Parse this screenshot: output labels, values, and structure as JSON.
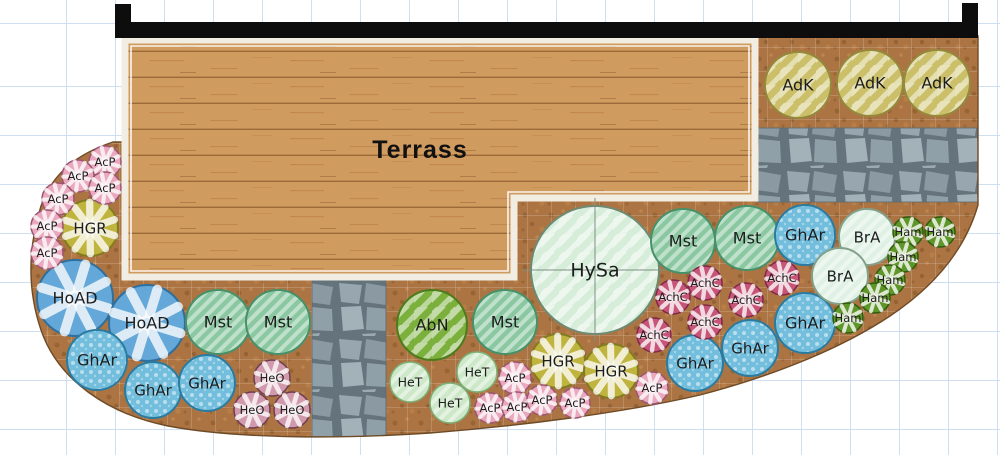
{
  "plan": {
    "terrace_label": "Terrass",
    "colors": {
      "soil": "#ab7442",
      "wood": "#d09b5f",
      "wood_line": "#9c6a38",
      "stone_gap": "#64737c",
      "stone": "#98a7af",
      "wall": "#0d0d0d",
      "grid_line": "#cddff0",
      "bed_outline": "#6e4b26",
      "label_text": "#1d1d1d"
    },
    "species": {
      "AcP": {
        "fill": "#e9a8be",
        "stroke": "#9c5570",
        "deco": "star",
        "spokes": 9
      },
      "HeO": {
        "fill": "#d09aac",
        "stroke": "#6f3c50",
        "deco": "star",
        "spokes": 8
      },
      "AchC": {
        "fill": "#c65578",
        "stroke": "#7f2847",
        "deco": "star",
        "spokes": 9
      },
      "Ham": {
        "fill": "#5f9629",
        "stroke": "#2f5c0e",
        "deco": "star",
        "spokes": 8
      },
      "HGR": {
        "fill": "#bfb43d",
        "stroke": "#837b20",
        "deco": "star",
        "spokes": 10
      },
      "HoAD": {
        "fill": "#63a8d8",
        "stroke": "#2e6f9d",
        "deco": "star",
        "spokes": 8
      },
      "AdK": {
        "fill": "#cbc069",
        "stroke": "#94893c",
        "deco": "hatch2"
      },
      "GhAr": {
        "fill": "#72bedc",
        "stroke": "#2b7ba0",
        "deco": "dots"
      },
      "Mst": {
        "fill": "#8bc8a2",
        "stroke": "#47906a",
        "deco": "hatch1"
      },
      "AbN": {
        "fill": "#7bb03d",
        "stroke": "#4e7b1b",
        "deco": "hatch2"
      },
      "HeT": {
        "fill": "#cde8c8",
        "stroke": "#7cb077",
        "deco": "hatch1"
      },
      "HySa": {
        "fill": "#d6edda",
        "stroke": "#6d8a74",
        "deco": "hatch2",
        "crosshair": true
      },
      "BrA": {
        "fill": "#def1e4",
        "stroke": "#84a08b",
        "deco": "hatch1"
      }
    },
    "plants": [
      {
        "code": "HySa",
        "x": 595,
        "y": 270,
        "r": 64
      },
      {
        "code": "AdK",
        "x": 798,
        "y": 85,
        "r": 33
      },
      {
        "code": "AdK",
        "x": 870,
        "y": 83,
        "r": 33
      },
      {
        "code": "AdK",
        "x": 937,
        "y": 83,
        "r": 33
      },
      {
        "code": "HoAD",
        "x": 75,
        "y": 298,
        "r": 38
      },
      {
        "code": "HoAD",
        "x": 147,
        "y": 323,
        "r": 38
      },
      {
        "code": "Mst",
        "x": 218,
        "y": 322,
        "r": 32
      },
      {
        "code": "Mst",
        "x": 278,
        "y": 322,
        "r": 32
      },
      {
        "code": "Mst",
        "x": 505,
        "y": 322,
        "r": 32
      },
      {
        "code": "Mst",
        "x": 683,
        "y": 241,
        "r": 32
      },
      {
        "code": "Mst",
        "x": 747,
        "y": 238,
        "r": 32
      },
      {
        "code": "AbN",
        "x": 432,
        "y": 325,
        "r": 35
      },
      {
        "code": "GhAr",
        "x": 97,
        "y": 360,
        "r": 30
      },
      {
        "code": "GhAr",
        "x": 153,
        "y": 390,
        "r": 28
      },
      {
        "code": "GhAr",
        "x": 207,
        "y": 383,
        "r": 28
      },
      {
        "code": "GhAr",
        "x": 805,
        "y": 235,
        "r": 30
      },
      {
        "code": "GhAr",
        "x": 805,
        "y": 323,
        "r": 30
      },
      {
        "code": "GhAr",
        "x": 750,
        "y": 348,
        "r": 28
      },
      {
        "code": "GhAr",
        "x": 695,
        "y": 363,
        "r": 28
      },
      {
        "code": "BrA",
        "x": 867,
        "y": 237,
        "r": 28
      },
      {
        "code": "BrA",
        "x": 840,
        "y": 276,
        "r": 28
      },
      {
        "code": "HGR",
        "x": 90,
        "y": 228,
        "r": 28
      },
      {
        "code": "HGR",
        "x": 558,
        "y": 361,
        "r": 27
      },
      {
        "code": "HGR",
        "x": 611,
        "y": 371,
        "r": 27
      },
      {
        "code": "HeT",
        "x": 410,
        "y": 382,
        "r": 20
      },
      {
        "code": "HeT",
        "x": 477,
        "y": 372,
        "r": 20
      },
      {
        "code": "HeT",
        "x": 450,
        "y": 403,
        "r": 20
      },
      {
        "code": "HeO",
        "x": 272,
        "y": 378,
        "r": 18
      },
      {
        "code": "HeO",
        "x": 252,
        "y": 410,
        "r": 18
      },
      {
        "code": "HeO",
        "x": 292,
        "y": 410,
        "r": 18
      },
      {
        "code": "AchC",
        "x": 673,
        "y": 297,
        "r": 17
      },
      {
        "code": "AchC",
        "x": 705,
        "y": 283,
        "r": 17
      },
      {
        "code": "AchC",
        "x": 782,
        "y": 278,
        "r": 17
      },
      {
        "code": "AchC",
        "x": 746,
        "y": 300,
        "r": 17
      },
      {
        "code": "AchC",
        "x": 705,
        "y": 322,
        "r": 17
      },
      {
        "code": "AchC",
        "x": 654,
        "y": 335,
        "r": 17
      },
      {
        "code": "Ham",
        "x": 908,
        "y": 232,
        "r": 15
      },
      {
        "code": "Ham",
        "x": 940,
        "y": 232,
        "r": 15
      },
      {
        "code": "Ham",
        "x": 903,
        "y": 257,
        "r": 15
      },
      {
        "code": "Ham",
        "x": 890,
        "y": 280,
        "r": 15
      },
      {
        "code": "Ham",
        "x": 875,
        "y": 298,
        "r": 15
      },
      {
        "code": "Ham",
        "x": 848,
        "y": 318,
        "r": 15
      },
      {
        "code": "AcP",
        "x": 105,
        "y": 162,
        "r": 16
      },
      {
        "code": "AcP",
        "x": 78,
        "y": 176,
        "r": 16
      },
      {
        "code": "AcP",
        "x": 105,
        "y": 188,
        "r": 16
      },
      {
        "code": "AcP",
        "x": 58,
        "y": 199,
        "r": 16
      },
      {
        "code": "AcP",
        "x": 47,
        "y": 226,
        "r": 16
      },
      {
        "code": "AcP",
        "x": 47,
        "y": 253,
        "r": 16
      },
      {
        "code": "AcP",
        "x": 515,
        "y": 378,
        "r": 16
      },
      {
        "code": "AcP",
        "x": 490,
        "y": 408,
        "r": 15
      },
      {
        "code": "AcP",
        "x": 517,
        "y": 407,
        "r": 15
      },
      {
        "code": "AcP",
        "x": 542,
        "y": 400,
        "r": 15
      },
      {
        "code": "AcP",
        "x": 575,
        "y": 403,
        "r": 15
      },
      {
        "code": "AcP",
        "x": 652,
        "y": 388,
        "r": 16
      }
    ]
  }
}
